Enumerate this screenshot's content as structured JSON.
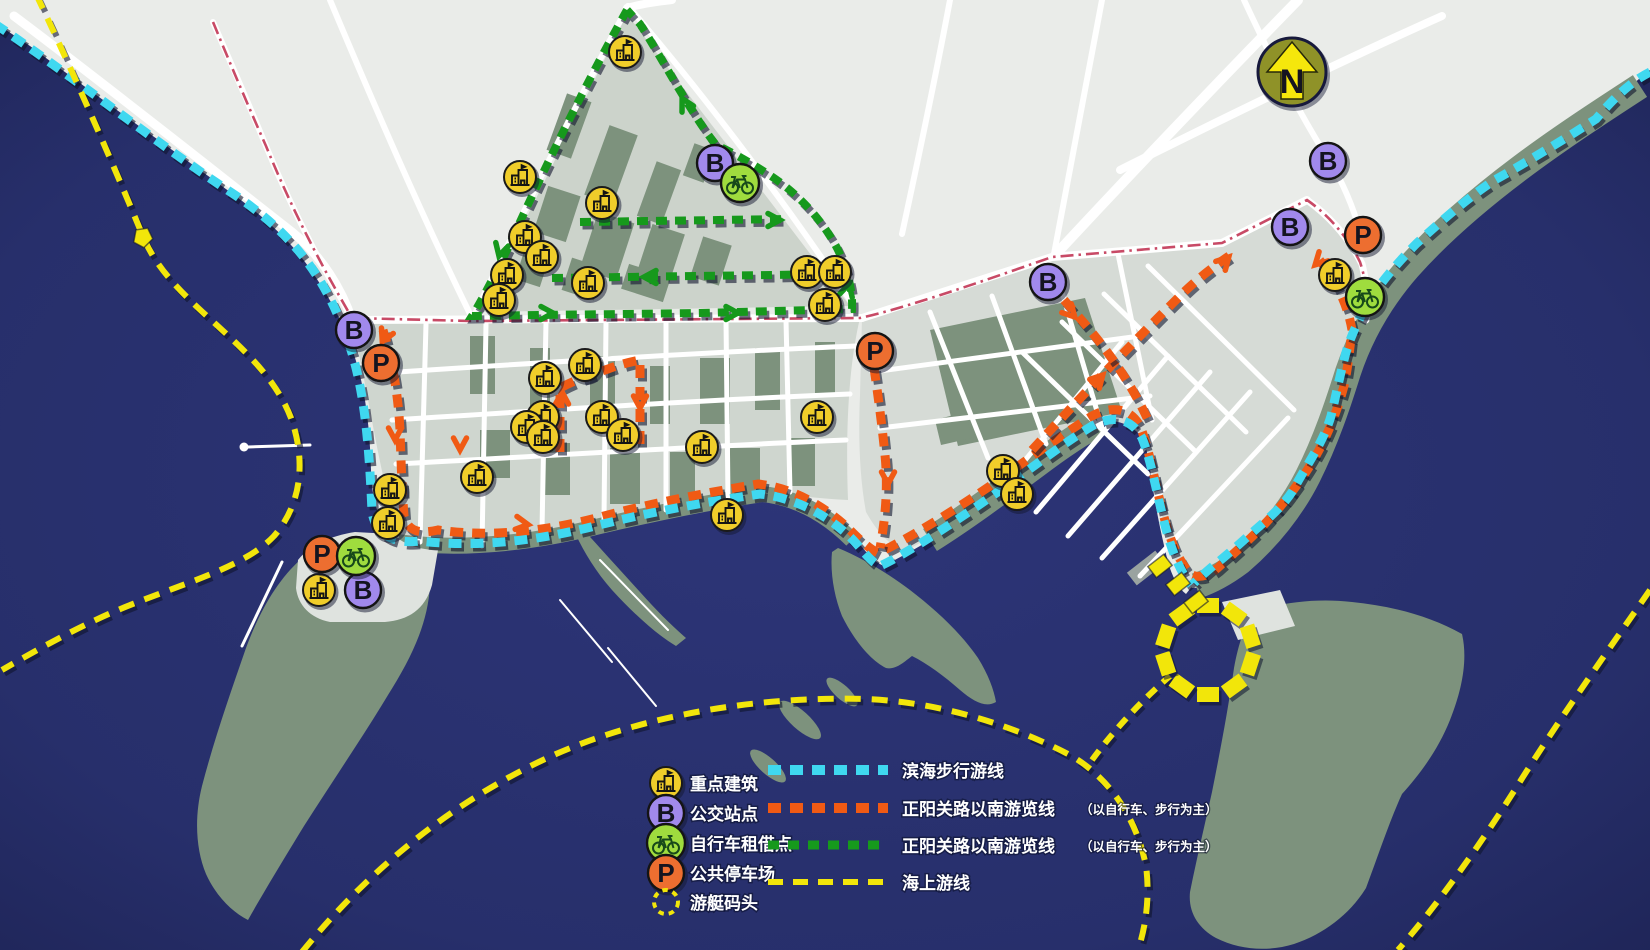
{
  "compass": {
    "label": "N"
  },
  "colors": {
    "water": "#2b3374",
    "water_edge": "#1e2456",
    "land": "#eaece9",
    "district": "#d2d8d2",
    "park": "#7d927d",
    "cyan": "#3fd8f0",
    "orange": "#f05a14",
    "green": "#16991c",
    "yellow": "#f2e60a",
    "red_road": "#c84a66",
    "bus_fill": "#a189ec",
    "parking_fill": "#ed6e30",
    "bike_fill": "#9fdc3e",
    "building_fill": "#f0cd2a"
  },
  "legend": {
    "markers": [
      {
        "icon": "building-icon",
        "label": "重点建筑"
      },
      {
        "icon": "bus-stop-icon",
        "label": "公交站点"
      },
      {
        "icon": "bike-rental-icon",
        "label": "自行车租借点"
      },
      {
        "icon": "parking-icon",
        "label": "公共停车场"
      },
      {
        "icon": "yacht-dock-icon",
        "label": "游艇码头"
      }
    ],
    "routes": [
      {
        "name": "coastal-walk",
        "color": "#3fd8f0",
        "dash": "13 9",
        "width": 10,
        "label": "滨海步行游线",
        "note": ""
      },
      {
        "name": "south-tour-orange",
        "color": "#f05a14",
        "dash": "13 9",
        "width": 10,
        "label": "正阳关路以南游览线",
        "note": "（以自行车、步行为主）"
      },
      {
        "name": "south-tour-green",
        "color": "#16991c",
        "dash": "11 8",
        "width": 9,
        "label": "正阳关路以南游览线",
        "note": "（以自行车、步行为主）"
      },
      {
        "name": "sea-tour",
        "color": "#f2e60a",
        "dash": "15 10",
        "width": 6,
        "label": "海上游线",
        "note": ""
      }
    ]
  },
  "map": {
    "routes": [
      {
        "name": "zhengyang-road",
        "color": "#c84a66",
        "width": 2.6,
        "dash": "13 5 2.5 5",
        "shadow": false,
        "d": "M 213,22 C 232,68 250,110 266,146 C 298,224 330,280 352,318 L 470,321 L 860,318 C 905,308 975,284 1052,257 L 1222,243 L 1307,200 C 1330,216 1348,238 1360,262 C 1366,280 1368,298 1367,316"
      },
      {
        "name": "south-tour-green-loop",
        "color": "#16991c",
        "width": 8,
        "dash": "11 8",
        "shadow": true,
        "d": "M 627,10 C 608,44 588,82 568,122 C 548,162 528,204 508,248 C 495,275 482,300 472,316 L 540,315 L 700,313 L 852,309 C 853,290 847,268 837,248 C 822,220 800,196 774,178 C 756,166 736,154 716,145 C 690,112 662,58 640,24 L 627,10"
      },
      {
        "name": "south-tour-green-inner-1",
        "color": "#16991c",
        "width": 8,
        "dash": "11 8",
        "shadow": true,
        "d": "M 580,222 L 788,219"
      },
      {
        "name": "south-tour-green-inner-2",
        "color": "#16991c",
        "width": 8,
        "dash": "11 8",
        "shadow": true,
        "d": "M 552,278 L 840,274"
      },
      {
        "name": "south-tour-orange-main",
        "color": "#f05a14",
        "width": 9,
        "dash": "13 9",
        "shadow": true,
        "d": "M 383,330 C 392,360 398,392 400,430 C 401,462 402,490 404,516 C 408,532 420,534 438,530 C 495,538 550,530 600,517 C 652,503 706,493 758,484 C 795,488 826,508 848,528 C 858,538 868,548 878,553 C 898,544 940,520 990,486 C 1020,465 1060,436 1092,416 C 1112,405 1130,408 1140,426 C 1150,450 1156,490 1166,524 C 1172,545 1180,562 1190,574 C 1200,580 1212,574 1222,564 C 1240,548 1258,532 1272,516 C 1290,496 1306,474 1318,452 C 1330,430 1338,408 1344,386 C 1348,368 1350,346 1352,330 C 1348,306 1336,280 1318,258"
      },
      {
        "name": "south-tour-orange-drop",
        "color": "#f05a14",
        "width": 9,
        "dash": "13 9",
        "shadow": true,
        "d": "M 874,368 C 878,395 882,425 885,455 C 888,485 886,515 880,548"
      },
      {
        "name": "south-tour-orange-loop",
        "color": "#f05a14",
        "width": 9,
        "dash": "13 9",
        "shadow": true,
        "d": "M 560,452 L 560,388 C 575,380 592,374 608,369 C 618,365 630,362 640,360 L 640,446"
      },
      {
        "name": "south-tour-orange-zigzag-1",
        "color": "#f05a14",
        "width": 9,
        "dash": "13 9",
        "shadow": true,
        "d": "M 1032,450 C 1080,398 1130,345 1180,296 C 1196,280 1214,266 1232,254"
      },
      {
        "name": "south-tour-orange-zigzag-2",
        "color": "#f05a14",
        "width": 9,
        "dash": "13 9",
        "shadow": true,
        "d": "M 1064,300 C 1095,335 1125,370 1148,420"
      },
      {
        "name": "coastal-walk-west",
        "color": "#3fd8f0",
        "width": 9,
        "dash": "13 9",
        "shadow": true,
        "d": "M -5,24 C 70,74 160,146 232,193 C 295,235 325,278 347,338 C 364,385 369,440 372,512 C 376,536 395,544 420,541 C 480,548 540,540 595,526 C 650,512 706,502 760,494 C 798,498 832,518 854,541 C 864,552 872,563 880,566 C 900,557 940,532 992,496 C 1020,477 1062,444 1092,426 C 1114,414 1132,419 1142,438 C 1152,462 1158,502 1168,536 C 1174,557 1182,574 1191,585"
      },
      {
        "name": "coastal-walk-east",
        "color": "#3fd8f0",
        "width": 9,
        "dash": "13 9",
        "shadow": true,
        "d": "M 1650,72 C 1630,82 1612,100 1596,119 C 1560,142 1520,166 1493,181 C 1462,202 1436,226 1417,243 C 1400,260 1380,283 1369,301 C 1358,320 1348,342 1344,360 C 1340,375 1336,395 1331,416 C 1324,440 1310,460 1297,483 C 1290,498 1276,512 1262,524 C 1247,537 1230,553 1213,566 C 1206,572 1199,578 1194,583"
      },
      {
        "name": "sea-tour-west-arc",
        "color": "#f2e60a",
        "width": 6,
        "dash": "16 11",
        "shadow": true,
        "d": "M 36,-6 C 72,70 108,152 142,234 C 170,306 262,342 291,418 C 306,460 302,504 274,536 C 244,568 180,584 118,610 C 80,626 40,648 2,670"
      },
      {
        "name": "sea-tour-south-arc",
        "color": "#f2e60a",
        "width": 6,
        "dash": "16 11",
        "shadow": true,
        "d": "M 302,952 C 375,862 462,796 556,754 C 648,714 760,696 866,699 C 938,702 1010,724 1068,754 C 1108,776 1136,816 1146,866 C 1150,896 1146,926 1138,950"
      },
      {
        "name": "sea-tour-dock-link",
        "color": "#f2e60a",
        "width": 6,
        "dash": "12 9",
        "shadow": true,
        "d": "M 1092,760 C 1114,730 1142,700 1170,676"
      },
      {
        "name": "sea-tour-east-arc",
        "color": "#f2e60a",
        "width": 6,
        "dash": "16 11",
        "shadow": true,
        "d": "M 1650,590 C 1600,662 1556,724 1516,788 C 1478,848 1438,904 1398,950"
      }
    ],
    "markers": {
      "building": [
        [
          625,
          52
        ],
        [
          520,
          177
        ],
        [
          602,
          203
        ],
        [
          525,
          237
        ],
        [
          542,
          257
        ],
        [
          507,
          275
        ],
        [
          499,
          300
        ],
        [
          588,
          283
        ],
        [
          807,
          272
        ],
        [
          835,
          272
        ],
        [
          825,
          305
        ],
        [
          585,
          365
        ],
        [
          545,
          378
        ],
        [
          543,
          417
        ],
        [
          527,
          427
        ],
        [
          543,
          437
        ],
        [
          602,
          417
        ],
        [
          623,
          435
        ],
        [
          702,
          447
        ],
        [
          817,
          417
        ],
        [
          477,
          477
        ],
        [
          727,
          515
        ],
        [
          1003,
          471
        ],
        [
          1017,
          494
        ],
        [
          390,
          490
        ],
        [
          388,
          523
        ],
        [
          319,
          590
        ],
        [
          1335,
          275
        ]
      ],
      "bus": [
        [
          354,
          330
        ],
        [
          715,
          163
        ],
        [
          1048,
          282
        ],
        [
          1290,
          227
        ],
        [
          1328,
          161
        ],
        [
          363,
          590
        ]
      ],
      "parking": [
        [
          381,
          363
        ],
        [
          875,
          351
        ],
        [
          1363,
          235
        ],
        [
          322,
          554
        ]
      ],
      "bike": [
        [
          740,
          183
        ],
        [
          1365,
          297
        ],
        [
          356,
          556
        ]
      ]
    },
    "yacht_dock": {
      "x": 1208,
      "y": 650,
      "r": 44,
      "blocks": 10
    },
    "landing_blocks": [
      [
        1160,
        566,
        -38
      ],
      [
        1178,
        584,
        -38
      ],
      [
        1196,
        602,
        -38
      ]
    ],
    "arrows": [
      {
        "x": 500,
        "y": 252,
        "a": 105,
        "c": "#16991c"
      },
      {
        "x": 684,
        "y": 102,
        "a": -118,
        "c": "#16991c"
      },
      {
        "x": 776,
        "y": 220,
        "a": 0,
        "c": "#16991c"
      },
      {
        "x": 648,
        "y": 277,
        "a": 180,
        "c": "#16991c"
      },
      {
        "x": 549,
        "y": 313,
        "a": 0,
        "c": "#16991c"
      },
      {
        "x": 734,
        "y": 313,
        "a": 0,
        "c": "#16991c"
      },
      {
        "x": 848,
        "y": 288,
        "a": -75,
        "c": "#16991c"
      },
      {
        "x": 384,
        "y": 338,
        "a": 115,
        "c": "#f05a14"
      },
      {
        "x": 395,
        "y": 436,
        "a": 90,
        "c": "#f05a14"
      },
      {
        "x": 460,
        "y": 446,
        "a": 90,
        "c": "#f05a14"
      },
      {
        "x": 562,
        "y": 396,
        "a": -90,
        "c": "#f05a14"
      },
      {
        "x": 640,
        "y": 404,
        "a": 90,
        "c": "#f05a14"
      },
      {
        "x": 888,
        "y": 480,
        "a": 90,
        "c": "#f05a14"
      },
      {
        "x": 524,
        "y": 524,
        "a": 8,
        "c": "#f05a14"
      },
      {
        "x": 1100,
        "y": 378,
        "a": -47,
        "c": "#f05a14"
      },
      {
        "x": 1226,
        "y": 260,
        "a": -47,
        "c": "#f05a14"
      },
      {
        "x": 1072,
        "y": 314,
        "a": 47,
        "c": "#f05a14"
      },
      {
        "x": 1318,
        "y": 262,
        "a": 135,
        "c": "#f05a14"
      }
    ],
    "sea_pentagon": {
      "x": 143,
      "y": 237,
      "a": 28
    }
  }
}
